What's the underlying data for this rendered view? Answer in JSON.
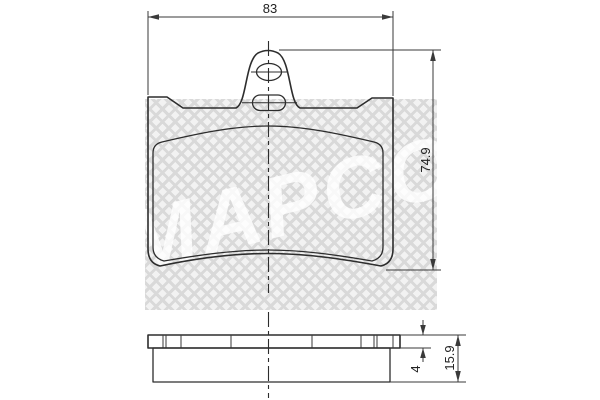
{
  "watermark": {
    "text": "MAPCO"
  },
  "top_view": {
    "width_dim_label": "83",
    "height_dim_label": "74.9"
  },
  "side_view": {
    "backplate_thickness_label": "4",
    "total_thickness_label": "15.9"
  },
  "colors": {
    "line": "#2d2d2d",
    "dimension": "#3a3a3a",
    "watermark_hatch": "#d9d9d9",
    "watermark_bg": "#f2f2f2"
  }
}
